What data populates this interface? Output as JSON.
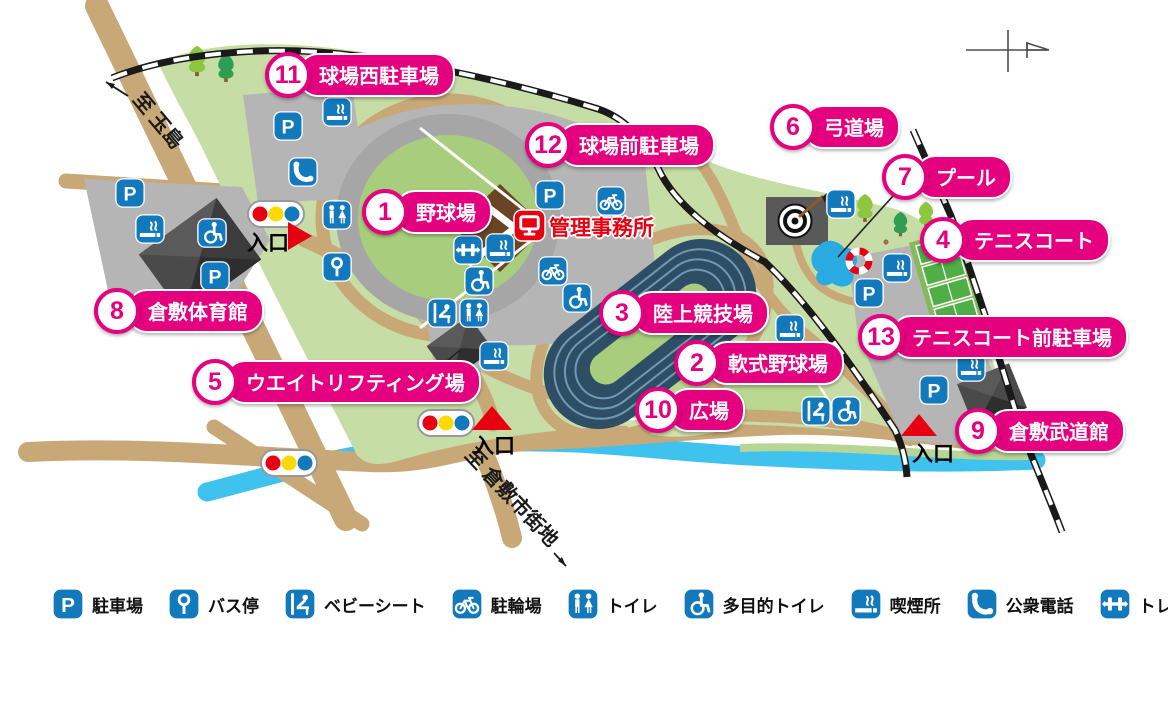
{
  "colors": {
    "accent_pink": "#e4007f",
    "icon_blue": "#1279bd",
    "alert_red": "#e60012",
    "signal_yellow": "#ffd900",
    "road_tan": "#c9a877",
    "park_green": "#c6dda6",
    "field_green": "#a8cd7d",
    "river_blue": "#3fc2ee",
    "track_navy": "#2e4e66",
    "parking_gray": "#b5b5b5",
    "building_gray": "#4a4a4a",
    "railway_black": "#1a1a1a"
  },
  "facilities": [
    {
      "num": "1",
      "label": "野球場"
    },
    {
      "num": "2",
      "label": "軟式野球場"
    },
    {
      "num": "3",
      "label": "陸上競技場"
    },
    {
      "num": "4",
      "label": "テニスコート"
    },
    {
      "num": "5",
      "label": "ウエイトリフティング場"
    },
    {
      "num": "6",
      "label": "弓道場"
    },
    {
      "num": "7",
      "label": "プール"
    },
    {
      "num": "8",
      "label": "倉敷体育館"
    },
    {
      "num": "9",
      "label": "倉敷武道館"
    },
    {
      "num": "10",
      "label": "広場"
    },
    {
      "num": "11",
      "label": "球場西駐車場"
    },
    {
      "num": "12",
      "label": "球場前駐車場"
    },
    {
      "num": "13",
      "label": "テニスコート前駐車場"
    }
  ],
  "management_office": {
    "icon": "monitor-icon",
    "label": "管理事務所"
  },
  "entrances": [
    {
      "label": "入口"
    },
    {
      "label": "入口"
    },
    {
      "label": "入口"
    }
  ],
  "road_labels": {
    "to_tamashima": "至 玉島",
    "to_kurashiki_city": "至 倉敷市街地"
  },
  "icons": {
    "parking-glyph": "P",
    "map_marker_names": [
      "parking-icon",
      "bus-stop-icon",
      "baby-seat-icon",
      "bicycle-parking-icon",
      "toilet-icon",
      "accessible-toilet-icon",
      "smoking-area-icon",
      "public-phone-icon",
      "training-room-icon",
      "monitor-icon",
      "traffic-light-icon",
      "entrance-triangle-icon",
      "north-arrow-icon",
      "archery-target-icon",
      "pool-icon",
      "life-ring-icon",
      "tree-icon"
    ]
  },
  "legend": {
    "items": [
      {
        "icon": "parking-icon",
        "label": "駐車場"
      },
      {
        "icon": "bus-stop-icon",
        "label": "バス停"
      },
      {
        "icon": "baby-seat-icon",
        "label": "ベビーシート"
      },
      {
        "icon": "bicycle-parking-icon",
        "label": "駐輪場"
      },
      {
        "icon": "toilet-icon",
        "label": "トイレ"
      },
      {
        "icon": "accessible-toilet-icon",
        "label": "多目的トイレ"
      },
      {
        "icon": "smoking-area-icon",
        "label": "喫煙所"
      },
      {
        "icon": "public-phone-icon",
        "label": "公衆電話"
      },
      {
        "icon": "training-room-icon",
        "label": "トレーニング室"
      }
    ]
  }
}
